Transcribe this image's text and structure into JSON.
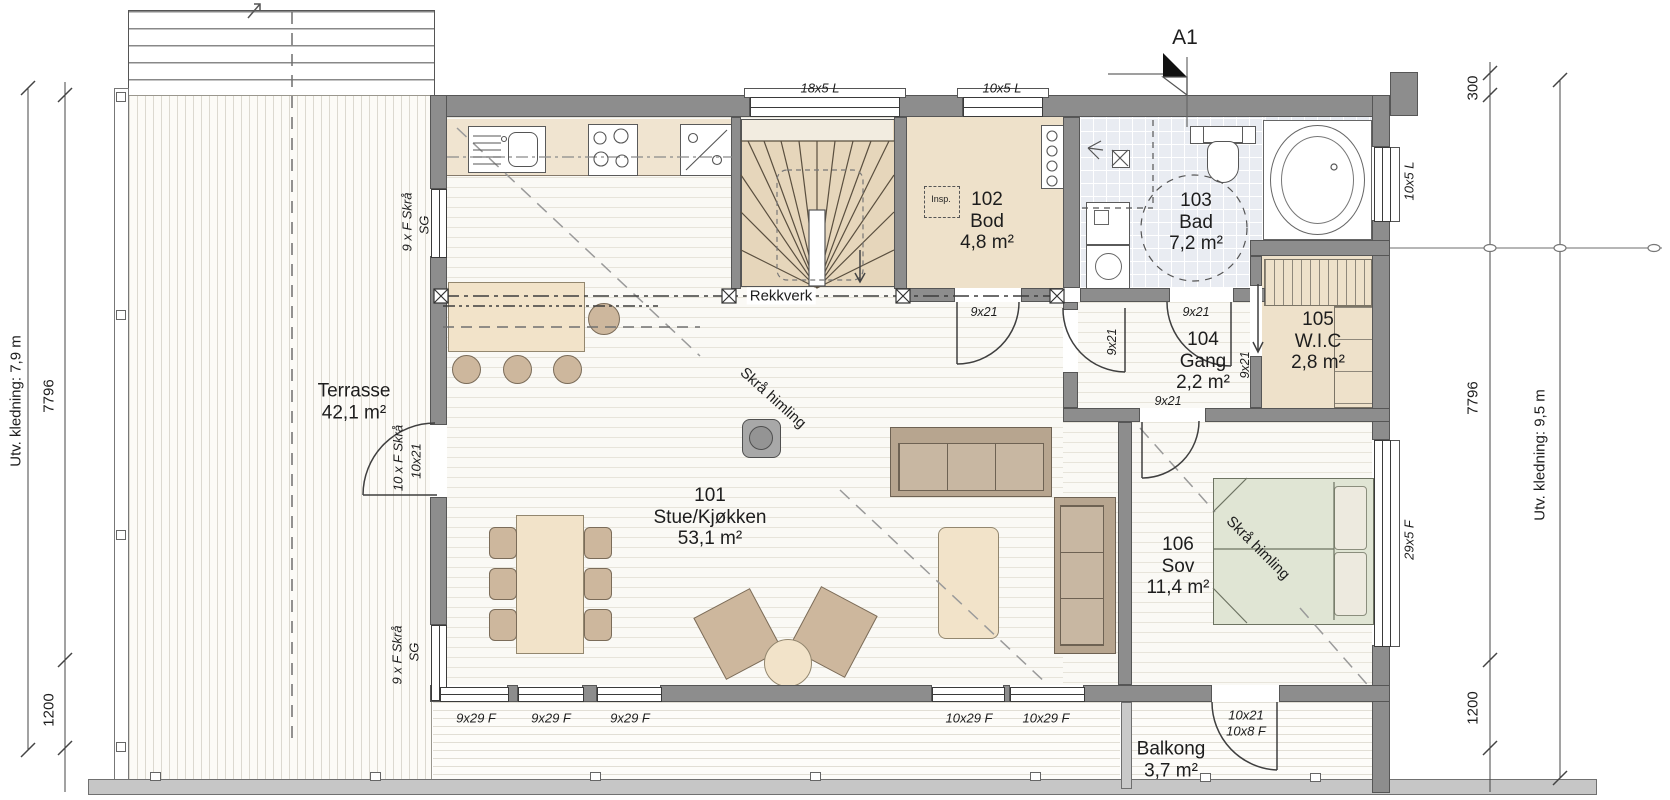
{
  "section_marker": {
    "label": "A1"
  },
  "rooms": {
    "stue": {
      "number": "101",
      "name": "Stue/Kjøkken",
      "area": "53,1 m²"
    },
    "bod": {
      "number": "102",
      "name": "Bod",
      "area": "4,8 m²"
    },
    "bad": {
      "number": "103",
      "name": "Bad",
      "area": "7,2 m²"
    },
    "gang": {
      "number": "104",
      "name": "Gang",
      "area": "2,2 m²"
    },
    "wic": {
      "number": "105",
      "name": "W.I.C",
      "area": "2,8 m²"
    },
    "sov": {
      "number": "106",
      "name": "Sov",
      "area": "11,4 m²"
    }
  },
  "outdoor": {
    "terrasse": {
      "name": "Terrasse",
      "area": "42,1 m²"
    },
    "balkong": {
      "name": "Balkong",
      "area": "3,7 m²"
    }
  },
  "annotations": {
    "rekkverk": "Rekkverk",
    "skra_himling_stue": "Skrå himling",
    "skra_himling_sov": "Skrå himling",
    "insp": "Insp."
  },
  "windows": {
    "top_stair": "18x5 L",
    "top_bod": "10x5 L",
    "right_bad": "10x5 L",
    "right_sov": "29x5 F",
    "bottom_1": "9x29 F",
    "bottom_2": "9x29 F",
    "bottom_3": "9x29 F",
    "bottom_4": "10x29 F",
    "bottom_5": "10x29 F"
  },
  "doors": {
    "bod": "9x21",
    "bad": "9x21",
    "gang": "9x21",
    "wic": "9x21",
    "sov": "9x21",
    "balkong_line1": "10x21",
    "balkong_line2": "10x8 F",
    "terrasse_line1": "10 x F Skrå",
    "terrasse_line2": "10x21"
  },
  "facade_labels": {
    "left_top_line1": "9 x F Skrå",
    "left_top_line2": "SG",
    "left_bottom_line1": "9 x F Skrå",
    "left_bottom_line2": "SG"
  },
  "dimensions": {
    "left": {
      "total": "7796",
      "offset": "1200",
      "cladding": "Utv. kledning: 7,9 m"
    },
    "right": {
      "top": "300",
      "total": "7796",
      "offset": "1200",
      "cladding": "Utv. kledning: 9,5 m"
    }
  },
  "palette": {
    "wall_gray": "#8d8d8d",
    "beige_floor": "#eee1ca",
    "tile_blue": "#e9ecf2",
    "bed_green": "#e0e5d4",
    "furniture_tan": "#cdb79d",
    "stair_beige": "#e6d6bb"
  }
}
